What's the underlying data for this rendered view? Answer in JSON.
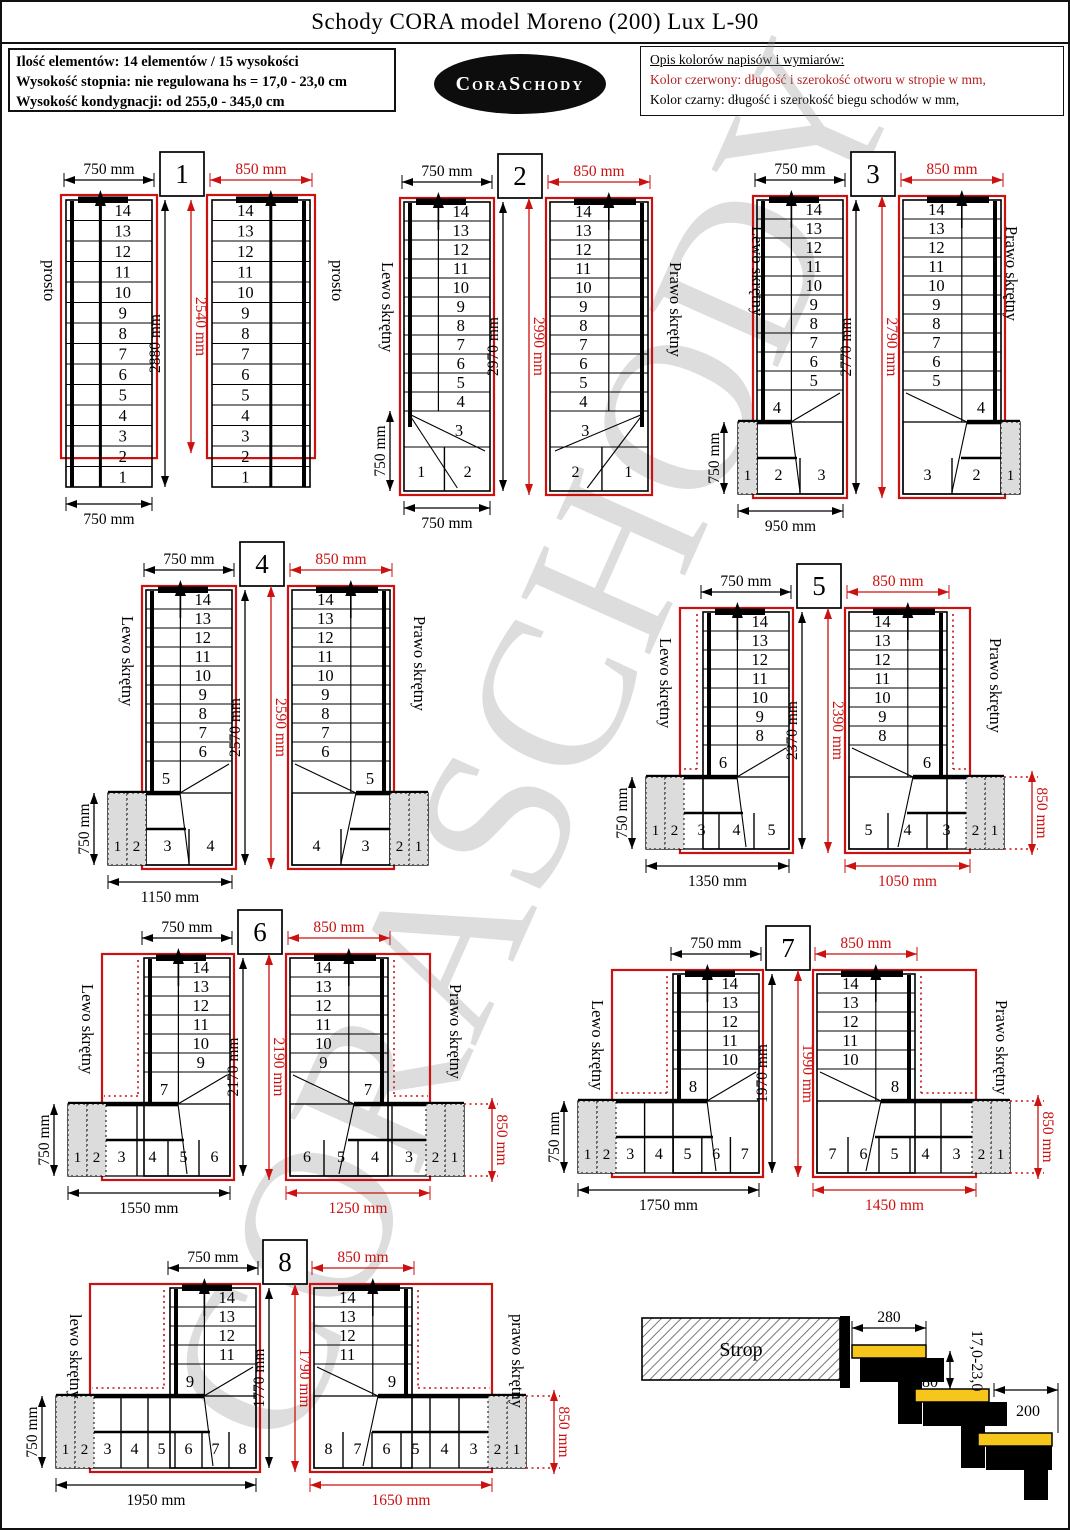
{
  "page": {
    "title": "Schody CORA model Moreno (200) Lux L-90",
    "watermark": "CORASCHODY"
  },
  "info_box": {
    "lines": [
      "Ilość elementów: 14 elementów / 15 wysokości",
      "Wysokość stopnia: nie regulowana  hs = 17,0 - 23,0 cm",
      "Wysokość kondygnacji: od 255,0 - 345,0 cm"
    ]
  },
  "logo": {
    "text": "CoraSchody"
  },
  "legend": {
    "title": "Opis kolorów napisów i wymiarów:",
    "red_line": "Kolor czerwony: długość i szerokość otworu w stropie w mm,",
    "black_line": "Kolor czarny:  długość i szerokość biegu schodów w mm,"
  },
  "colors": {
    "red": "#cc1111",
    "black": "#000000",
    "gray_fill": "#dcdcdc",
    "tread_yellow": "#f7c61c"
  },
  "variants": [
    {
      "number": "1",
      "left_label": "prosto",
      "right_label": "prosto",
      "top_dim_left": "750 mm",
      "top_dim_right": "850 mm",
      "height_dim_black": "2880 mm",
      "height_dim_red": "2540 mm",
      "bottom_dim_black": "750 mm",
      "straight_steps": [
        14,
        13,
        12,
        11,
        10,
        9,
        8,
        7,
        6,
        5,
        4,
        3,
        2,
        1
      ],
      "bottom_steps": [],
      "gray_count": 0
    },
    {
      "number": "2",
      "left_label": "Lewo skrętny",
      "right_label": "Prawo skrętny",
      "top_dim_left": "750 mm",
      "top_dim_right": "850 mm",
      "height_dim_black": "2970 mm",
      "height_dim_red": "2990 mm",
      "side_dim_left": "750 mm",
      "bottom_dim_black": "750 mm",
      "straight_steps": [
        14,
        13,
        12,
        11,
        10,
        9,
        8,
        7,
        6,
        5,
        4
      ],
      "winder_step": "3",
      "bottom_steps": [
        "1",
        "2"
      ],
      "gray_count": 0
    },
    {
      "number": "3",
      "left_label": "Lewo skrętny",
      "right_label": "Prawo skrętny",
      "top_dim_left": "750 mm",
      "top_dim_right": "850 mm",
      "height_dim_black": "2770 mm",
      "height_dim_red": "2790 mm",
      "side_dim_left": "750 mm",
      "bottom_dim_black": "950 mm",
      "straight_steps": [
        14,
        13,
        12,
        11,
        10,
        9,
        8,
        7,
        6,
        5
      ],
      "winder_step": "4",
      "bottom_steps": [
        "1",
        "2",
        "3"
      ],
      "gray_count": 1
    },
    {
      "number": "4",
      "left_label": "Lewo skrętny",
      "right_label": "Prawo skrętny",
      "top_dim_left": "750 mm",
      "top_dim_right": "850 mm",
      "height_dim_black": "2570 mm",
      "height_dim_red": "2590 mm",
      "side_dim_left": "750 mm",
      "bottom_dim_black": "1150 mm",
      "straight_steps": [
        14,
        13,
        12,
        11,
        10,
        9,
        8,
        7,
        6
      ],
      "winder_step": "5",
      "bottom_steps": [
        "1",
        "2",
        "3",
        "4"
      ],
      "gray_count": 2
    },
    {
      "number": "5",
      "left_label": "Lewo skrętny",
      "right_label": "Prawo skrętny",
      "top_dim_left": "750 mm",
      "top_dim_right": "850 mm",
      "height_dim_black": "2370 mm",
      "height_dim_red": "2390 mm",
      "side_dim_left": "750 mm",
      "bottom_dim_black": "1350 mm",
      "bottom_dim_red": "1050 mm",
      "side_dim_right_red": "850 mm",
      "straight_steps": [
        14,
        13,
        12,
        11,
        10,
        9,
        8
      ],
      "winder_step": "6",
      "bottom_steps": [
        "1",
        "2",
        "3",
        "4",
        "5"
      ],
      "gray_count": 2
    },
    {
      "number": "6",
      "left_label": "Lewo skrętny",
      "right_label": "Prawo skrętny",
      "top_dim_left": "750 mm",
      "top_dim_right": "850 mm",
      "height_dim_black": "2170 mm",
      "height_dim_red": "2190 mm",
      "side_dim_left": "750 mm",
      "bottom_dim_black": "1550 mm",
      "bottom_dim_red": "1250 mm",
      "side_dim_right_red": "850 mm",
      "straight_steps": [
        14,
        13,
        12,
        11,
        10,
        9
      ],
      "winder_step": "7",
      "bottom_steps": [
        "1",
        "2",
        "3",
        "4",
        "5",
        "6"
      ],
      "gray_count": 2
    },
    {
      "number": "7",
      "left_label": "Lewo skrętny",
      "right_label": "Prawo skrętny",
      "top_dim_left": "750 mm",
      "top_dim_right": "850 mm",
      "height_dim_black": "1970 mm",
      "height_dim_red": "1990 mm",
      "side_dim_left": "750 mm",
      "bottom_dim_black": "1750 mm",
      "bottom_dim_red": "1450 mm",
      "side_dim_right_red": "850 mm",
      "straight_steps": [
        14,
        13,
        12,
        11,
        10
      ],
      "winder_step": "8",
      "bottom_steps": [
        "1",
        "2",
        "3",
        "4",
        "5",
        "6",
        "7"
      ],
      "gray_count": 2
    },
    {
      "number": "8",
      "left_label": "lewo skrętny",
      "right_label": "prawo skrętny",
      "top_dim_left": "750 mm",
      "top_dim_right": "850 mm",
      "height_dim_black": "1770 mm",
      "height_dim_red": "1790 mm",
      "side_dim_left": "750 mm",
      "bottom_dim_black": "1950 mm",
      "bottom_dim_red": "1650 mm",
      "side_dim_right_red": "850 mm",
      "straight_steps": [
        14,
        13,
        12,
        11
      ],
      "winder_step": "9",
      "bottom_steps": [
        "1",
        "2",
        "3",
        "4",
        "5",
        "6",
        "7",
        "8"
      ],
      "gray_count": 2
    }
  ],
  "detail": {
    "strop_label": "Strop",
    "tread_depth": "280",
    "overlap": "80",
    "riser_range": "17,0-23,0",
    "going": "200"
  }
}
